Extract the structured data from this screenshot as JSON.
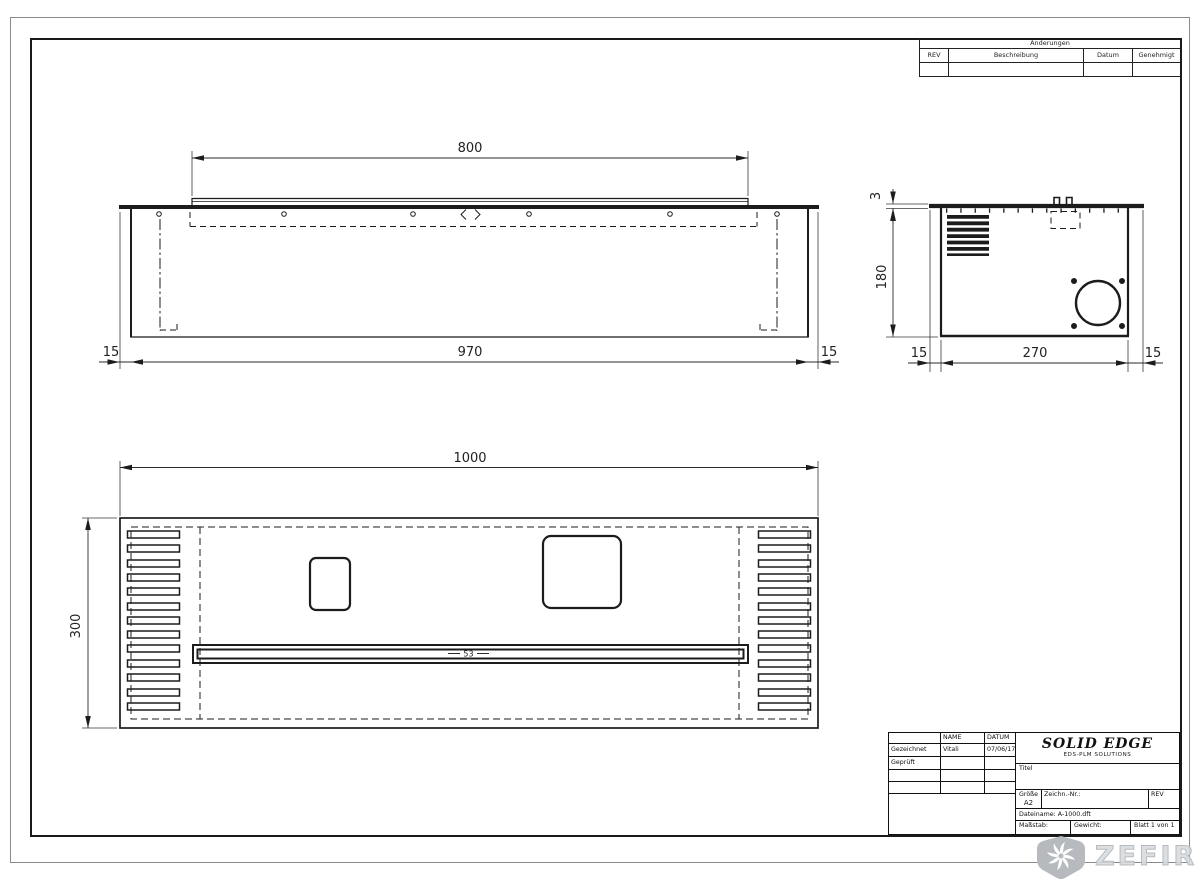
{
  "sheet": {
    "revision_table": {
      "title": "Änderungen",
      "columns": [
        "REV",
        "Beschreibung",
        "Datum",
        "Genehmigt"
      ]
    },
    "title_block": {
      "name_header": "NAME",
      "date_header": "DATUM",
      "drawn_label": "Gezeichnet",
      "drawn_name": "Vitali",
      "drawn_date": "07/06/17",
      "checked_label": "Geprüft",
      "brand": "SOLID EDGE",
      "brand_sub": "EDS-PLM SOLUTIONS",
      "title_label": "Titel",
      "size_label": "Größe",
      "size_value": "A2",
      "drawing_number_label": "Zeichn.-Nr.:",
      "rev_label": "REV",
      "filename": "Dateiname: A-1000.dft",
      "scale_label": "Maßstab:",
      "weight_label": "Gewicht:",
      "sheet_number": "Blatt 1 von 1"
    },
    "watermark": {
      "text": "ZEFIRE"
    }
  },
  "dimensions": {
    "front": {
      "flange_width": "800",
      "body_width": "970",
      "left_offset": "15",
      "right_offset": "15"
    },
    "side": {
      "plate_thickness": "3",
      "height": "180",
      "left_offset": "15",
      "depth": "270",
      "right_offset": "15"
    },
    "top": {
      "length": "1000",
      "depth": "300",
      "slot": "53"
    }
  }
}
